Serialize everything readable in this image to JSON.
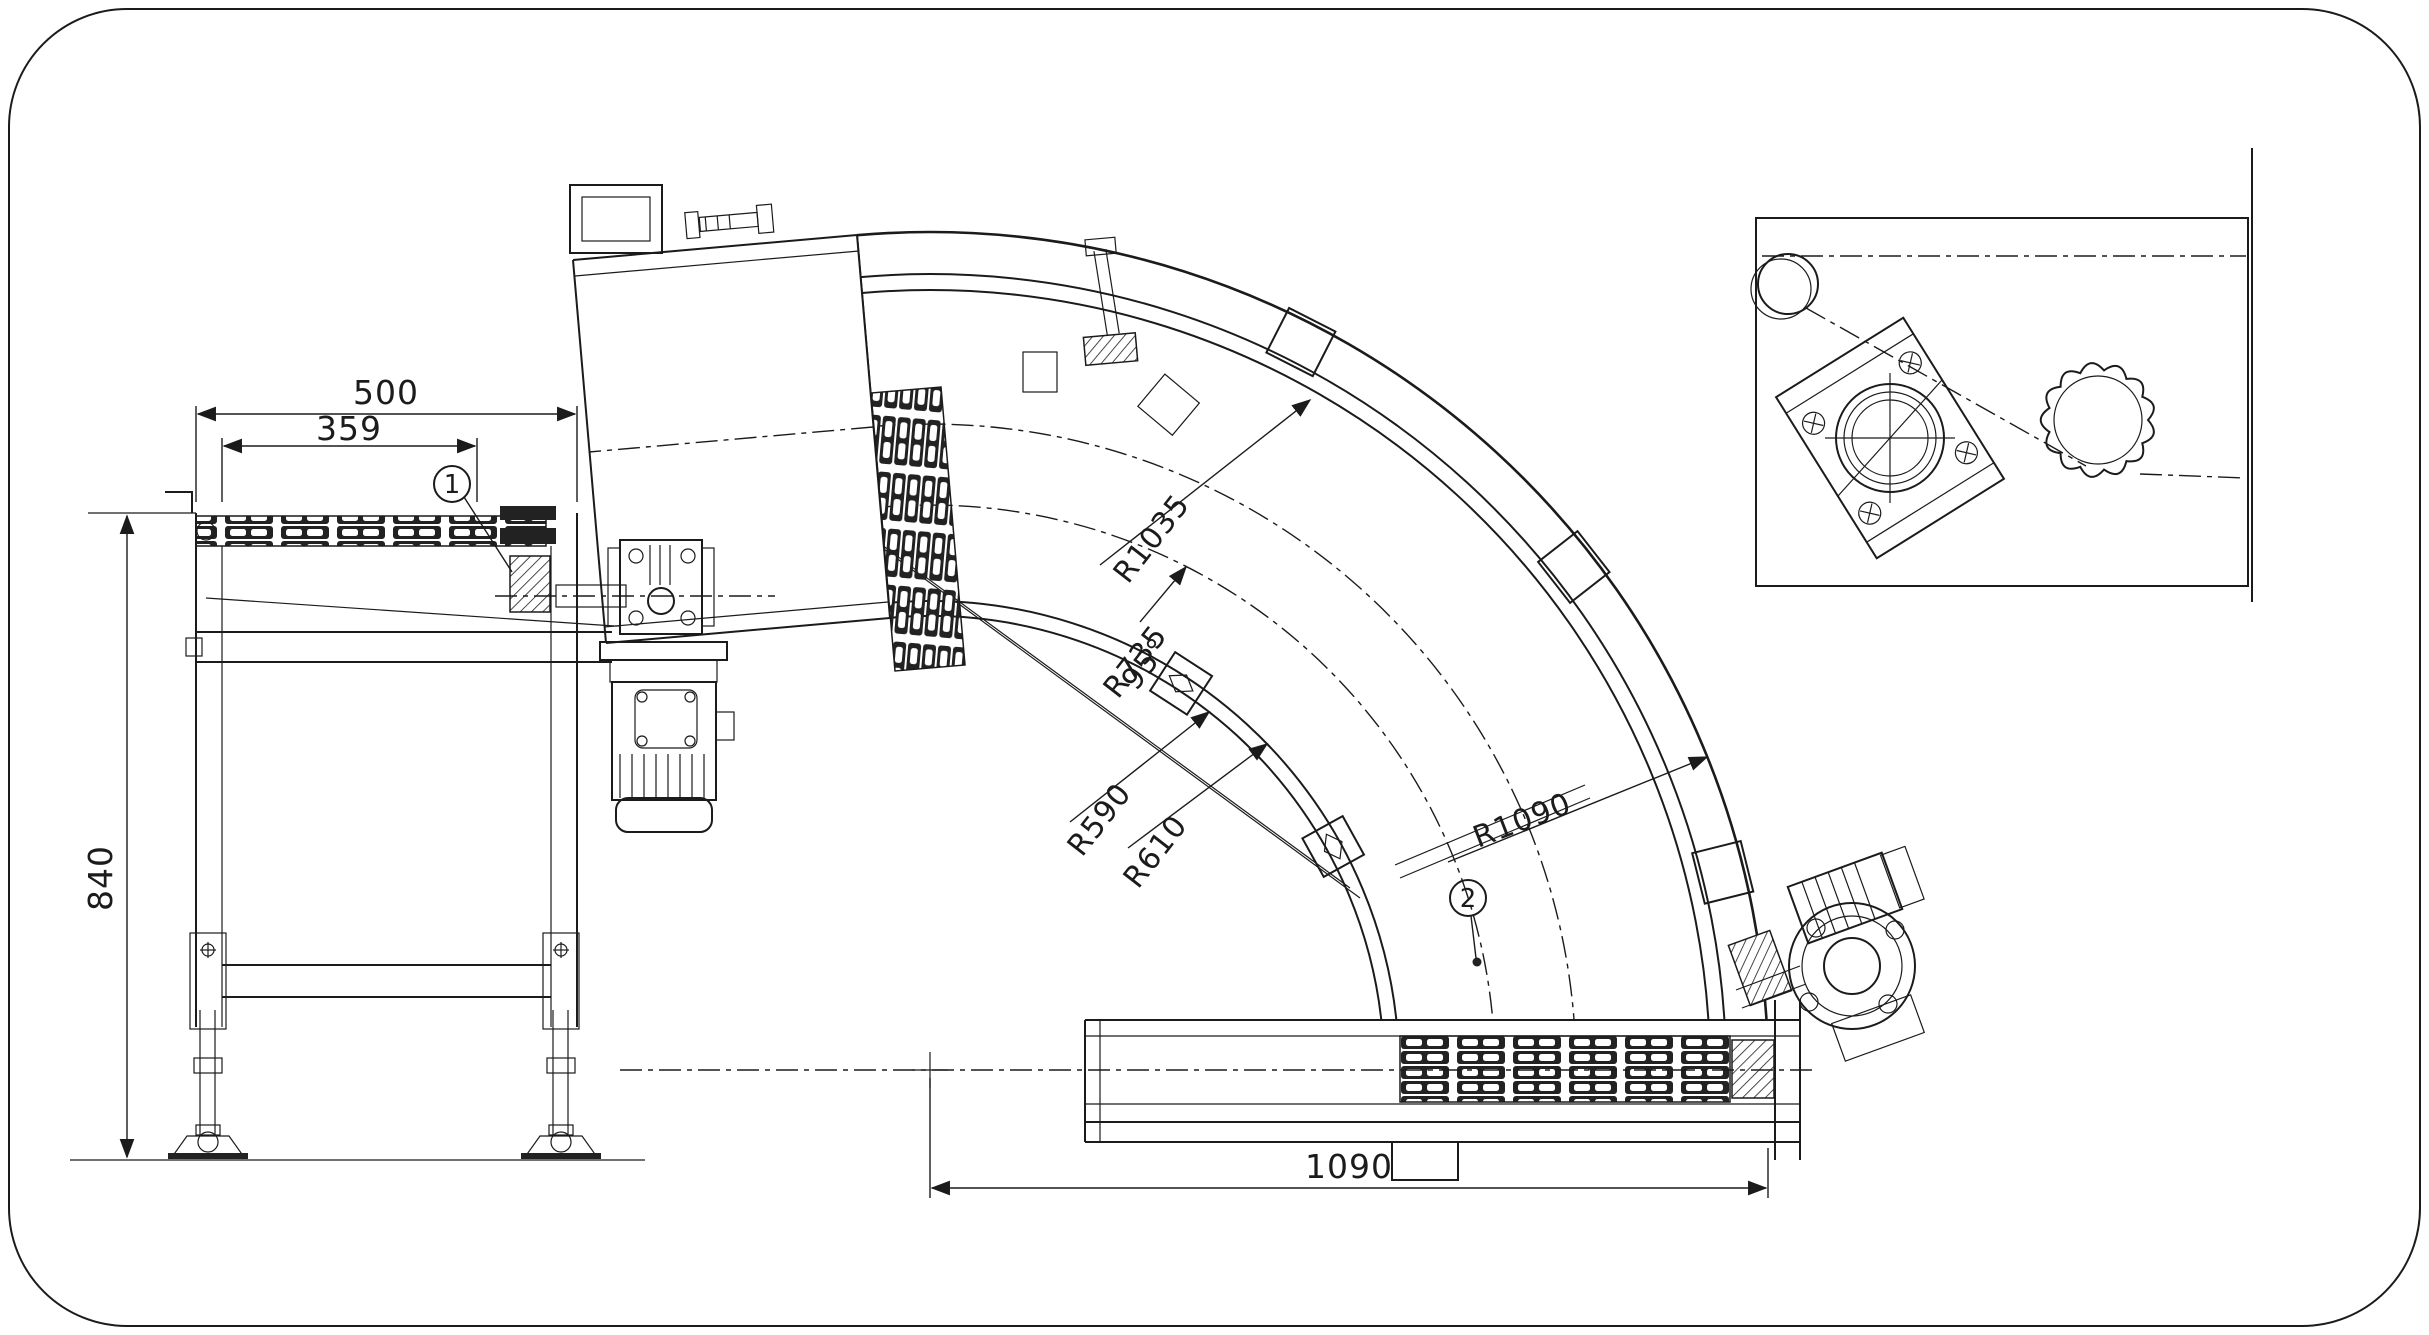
{
  "page": {
    "background": "#ffffff",
    "line_color": "#1b1b1b",
    "type_note": "technical drawing - curved chain conveyor"
  },
  "side_view": {
    "dim_width_total": "500",
    "dim_width_chain": "359",
    "dim_height": "840",
    "balloon_label": "1"
  },
  "plan_view": {
    "dim_span_bottom": "1090",
    "angle_label": "95°",
    "radius_outer_frame": "R1090",
    "radius_outer_chain": "R1035",
    "radius_pitch": "R735",
    "radius_chain_inner": "R610",
    "radius_frame_inner": "R590",
    "balloon_label": "2"
  },
  "detail_view": {}
}
